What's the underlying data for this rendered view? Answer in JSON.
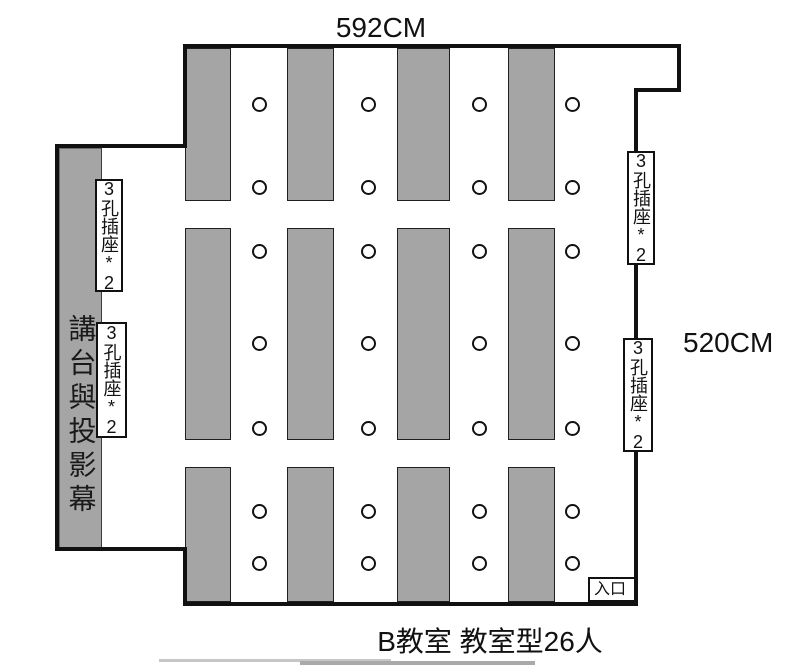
{
  "labels": {
    "top_dimension": "592CM",
    "right_dimension": "520CM",
    "outlet": "3孔插座*2",
    "podium": "講台與投影幕",
    "entrance": "入口",
    "caption": "B教室 教室型26人"
  },
  "colors": {
    "wall": "#111111",
    "desk_fill": "#a5a5a5",
    "desk_border": "#1f1f1f",
    "podium_fill": "#a5a5a5",
    "chair_fill": "#ffffff",
    "chair_border": "#111111",
    "background": "#ffffff"
  },
  "layout": {
    "room_outline_points": "185,46 679,46 679,90 636,90 636,604 185,604 185,549 57,549 57,146 185,146",
    "desk_columns": [
      {
        "x": 185,
        "w": 46
      },
      {
        "x": 287,
        "w": 47
      },
      {
        "x": 397,
        "w": 53
      },
      {
        "x": 508,
        "w": 47
      }
    ],
    "chair_x_centers": [
      259,
      368,
      479,
      572
    ],
    "rows": [
      {
        "y": 48,
        "h": 153,
        "chair_y": [
          104,
          187
        ]
      },
      {
        "y": 228,
        "h": 212,
        "chair_y": [
          251,
          343,
          428
        ]
      },
      {
        "y": 467,
        "h": 135,
        "chair_y": [
          511,
          563
        ]
      }
    ],
    "outlet_boxes": [
      {
        "x": 95,
        "y": 179,
        "w": 28,
        "h": 113
      },
      {
        "x": 96,
        "y": 322,
        "w": 31,
        "h": 116
      },
      {
        "x": 627,
        "y": 151,
        "w": 28,
        "h": 114
      },
      {
        "x": 623,
        "y": 338,
        "w": 30,
        "h": 114
      }
    ]
  }
}
